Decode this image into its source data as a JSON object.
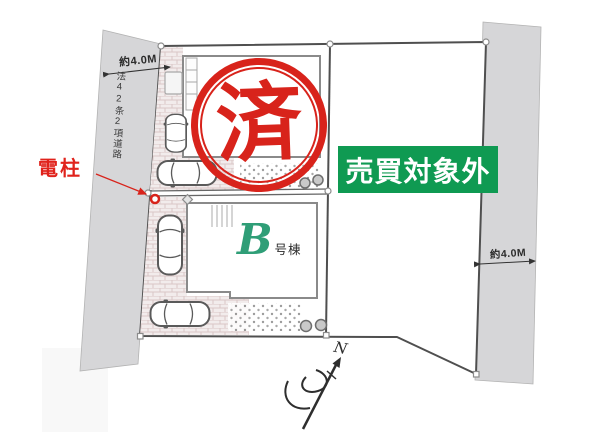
{
  "roads": {
    "left": {
      "width": "約4.0M",
      "name": "法42条2項道路"
    },
    "right": {
      "width": "約4.0M"
    }
  },
  "annotations": {
    "utility_pole_label": "電柱",
    "sold_stamp": "済",
    "not_for_sale": "売買対象外",
    "building_b_letter": "B",
    "building_b_suffix": "号棟",
    "compass_north": "N"
  },
  "colors": {
    "stamp_red": "#d8231b",
    "annotation_red": "#e0231c",
    "not_for_sale_green": "#0f9a52",
    "building_letter_green": "#2f9e77",
    "road_gray": "#d6d6d8",
    "boundary_gray": "#4f4f4f"
  }
}
